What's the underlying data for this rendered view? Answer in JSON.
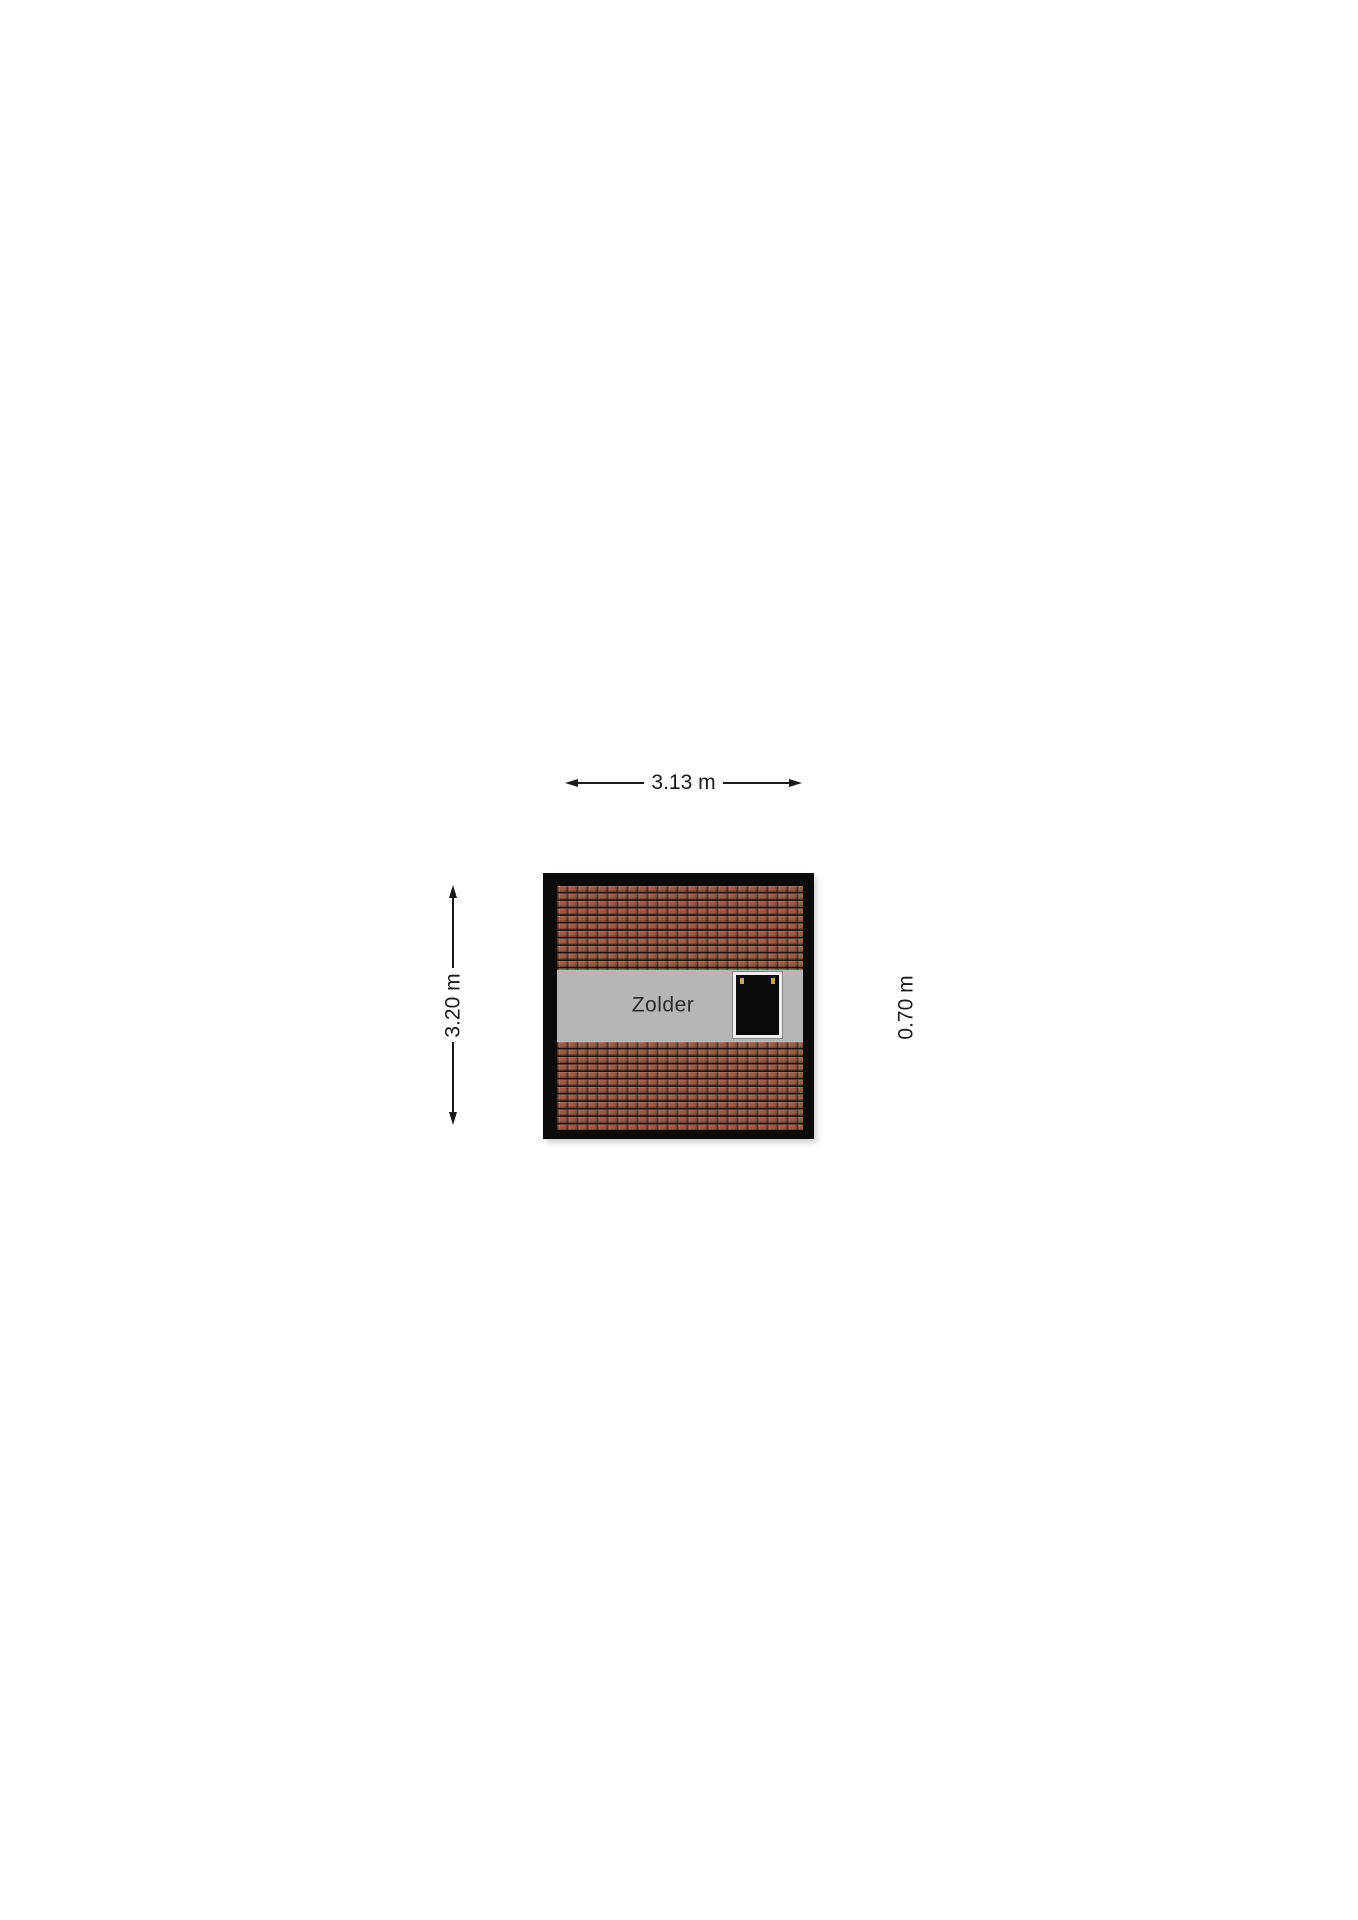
{
  "floorplan": {
    "room": {
      "label": "Zolder"
    },
    "dimensions": {
      "width": "3.13 m",
      "height": "3.20 m",
      "window": "0.70 m"
    },
    "colors": {
      "dim_color": "#1a1a1a",
      "wall": "#0b0b0b",
      "floor": "#b6b6b6",
      "room_text": "#2b2b2b",
      "tile_base": "#9a5b47",
      "window_fill": "#0a0a0a",
      "window_frame": "#f0f0f0",
      "window_hinge": "#c8a25f"
    }
  }
}
